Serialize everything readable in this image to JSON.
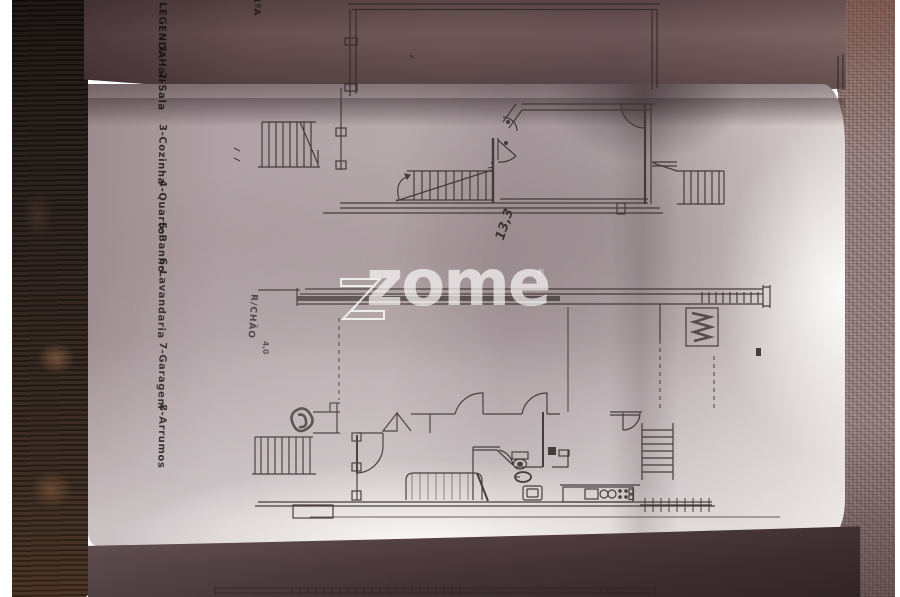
{
  "scene_type": "photographed architectural floor plan sheet, folded, on dark wood background",
  "legend": {
    "title": "LEGENDA",
    "items": [
      "1-Hall",
      "2-Sala",
      "3-Cozinha",
      "4-Quarto",
      "5-Banho",
      "6-Lavandaria",
      "7-Garagem",
      "8-Arrumos"
    ]
  },
  "watermark": {
    "text": "zome",
    "registered": "®",
    "color": "#ffffff"
  },
  "plans": {
    "upper": {
      "label_snippet": "1ºA",
      "annotation": "13,3"
    },
    "lower": {
      "label": "R/CHÃO",
      "annotation": "4,0"
    }
  },
  "colors": {
    "paper_light": "#b6a9ac",
    "paper_fold_dark": "#6e5759",
    "ink": "#3f3734",
    "wood_frame": "#2a1f19",
    "background_texture": "#8b7572",
    "watermark_white": "#fcfafa"
  }
}
